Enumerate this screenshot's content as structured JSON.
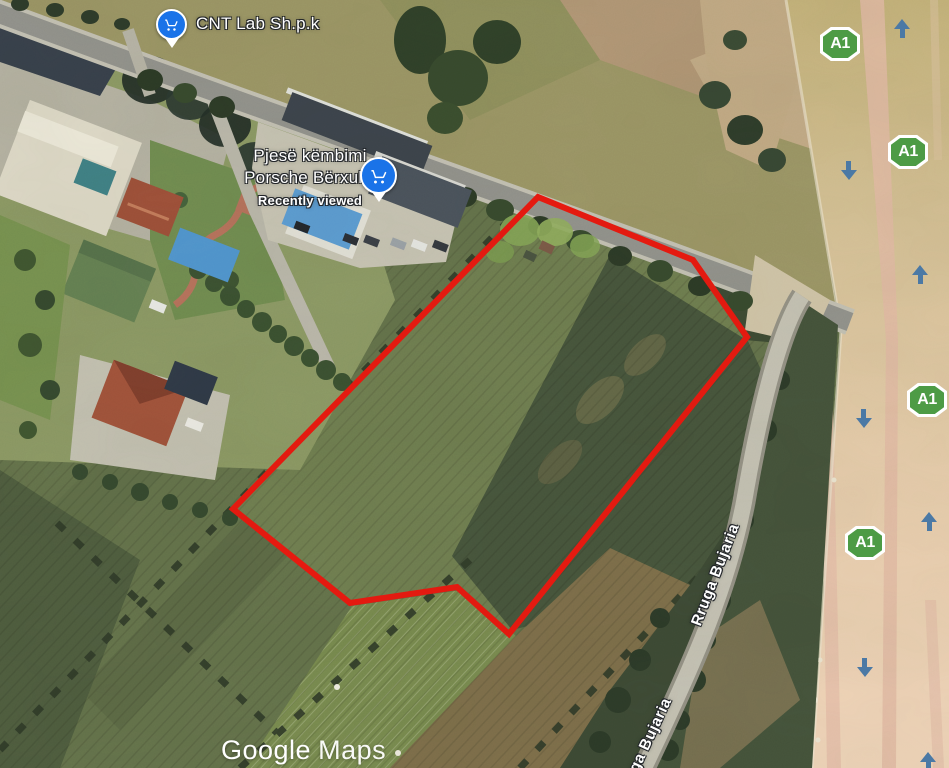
{
  "map": {
    "places": {
      "cnt_lab": {
        "label": "CNT Lab Sh.p.k"
      },
      "porsche": {
        "line1": "Pjesë këmbimi",
        "line2": "Porsche Bërxullë",
        "status": "Recently viewed"
      }
    },
    "roads": {
      "rruga_bujaria_upper": "Rruga Bujaria",
      "rruga_bujaria_lower": "Rruga Bujaria"
    },
    "badges": [
      {
        "label": "A1"
      },
      {
        "label": "A1"
      },
      {
        "label": "A1"
      },
      {
        "label": "A1"
      }
    ],
    "badge_color": "#4d9b45",
    "parcel": {
      "points": "538,197 693,260 747,337 509,634 457,587 350,603 233,509",
      "color": "#e8190f"
    },
    "watermark": {
      "brand": "Google",
      "product": "Maps"
    }
  }
}
